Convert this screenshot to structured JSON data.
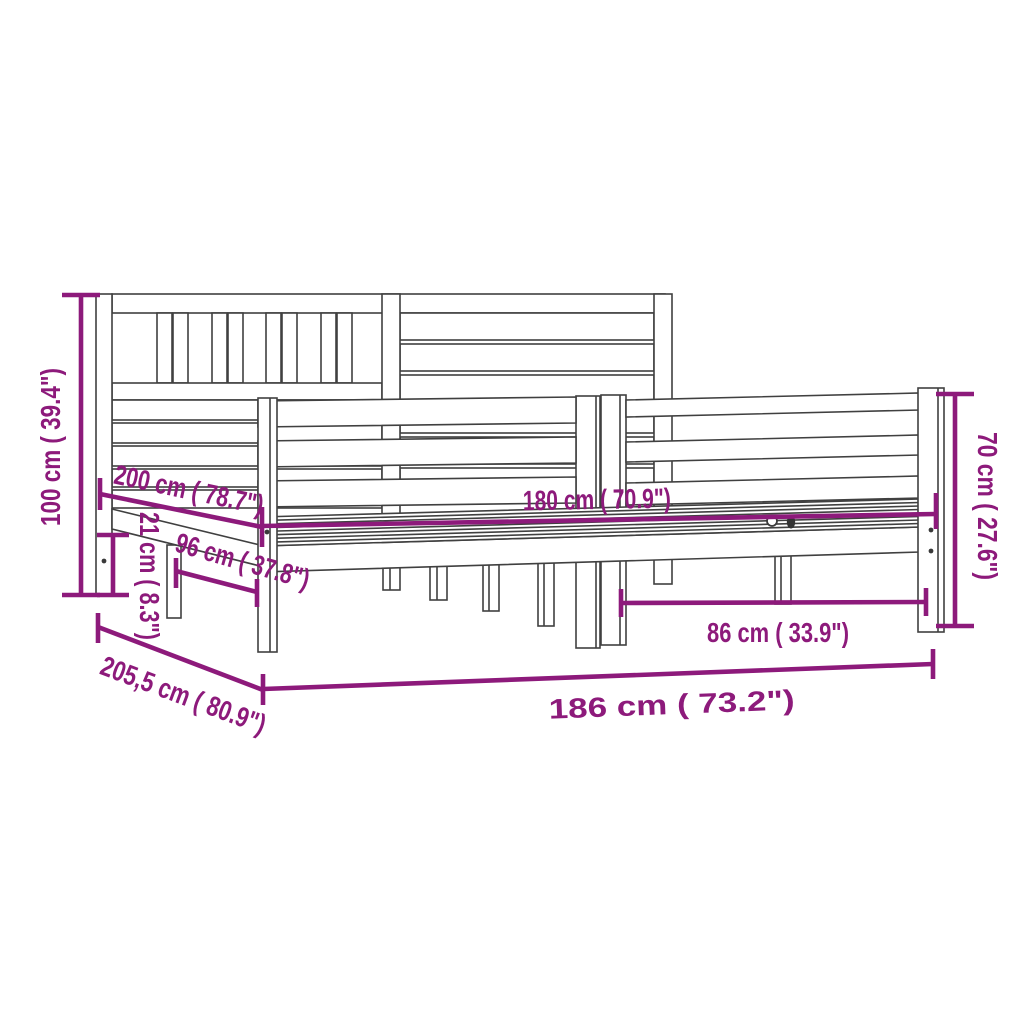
{
  "figure": {
    "type": "product-dimension-diagram",
    "subject": "wooden bed frame with headboard and footboard",
    "background_color": "#FFFFFF",
    "line_art_color": "#404040",
    "dimension_color": "#8D1A7B"
  },
  "dimensions": {
    "headboard_height": "100 cm ( 39.4\")",
    "frame_length": "200 cm ( 78.7\")",
    "base_height": "21 cm ( 8.3\")",
    "slat_section_width": "96 cm ( 37.8\")",
    "mattress_width": "180 cm ( 70.9\")",
    "footboard_height": "70 cm ( 27.6\")",
    "leg_span": "86 cm ( 33.9\")",
    "total_length": "205,5 cm ( 80.9\")",
    "total_width": "186 cm ( 73.2\")"
  }
}
